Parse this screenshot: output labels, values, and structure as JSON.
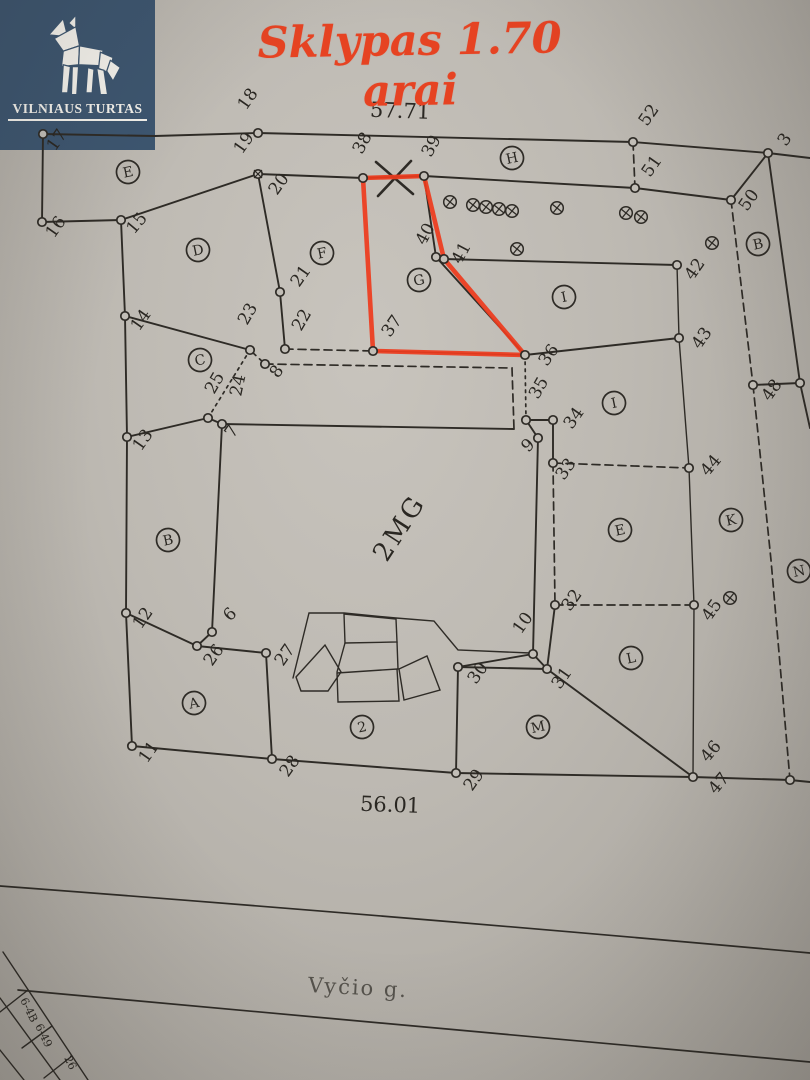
{
  "logo": {
    "brand": "VILNIAUS TURTAS",
    "icon": "wolf-icon",
    "bg_color": "#3d5670"
  },
  "title": {
    "text": "Sklypas 1.70 arai",
    "color": "#e64322"
  },
  "plan": {
    "top_dimension": "57.71",
    "bottom_dimension": "56.01",
    "building_label": "2MG",
    "street_label": "Vyčio g.",
    "highlight_color": "#ee3b1c",
    "corner_table_cells": [
      {
        "text": "6-4B",
        "x": 20,
        "y": 1000
      },
      {
        "text": "6-49",
        "x": 35,
        "y": 1026
      },
      {
        "text": "26",
        "x": 64,
        "y": 1058
      }
    ],
    "points": [
      {
        "label": "17",
        "x": 43,
        "y": 134,
        "lx": 55,
        "ly": 152,
        "r": -55
      },
      {
        "label": "18",
        "x": 258,
        "y": 133,
        "lx": 246,
        "ly": 111,
        "r": -55
      },
      {
        "label": "19",
        "x": 258,
        "y": 174,
        "lx": 242,
        "ly": 155,
        "r": -55,
        "crossed": true
      },
      {
        "label": "20",
        "x": 258,
        "y": 174,
        "lx": 277,
        "ly": 196,
        "r": -55,
        "nodot": true
      },
      {
        "label": "16",
        "x": 42,
        "y": 222,
        "lx": 54,
        "ly": 239,
        "r": -55
      },
      {
        "label": "15",
        "x": 121,
        "y": 220,
        "lx": 134,
        "ly": 235,
        "r": -50
      },
      {
        "label": "14",
        "x": 125,
        "y": 316,
        "lx": 139,
        "ly": 332,
        "r": -55
      },
      {
        "label": "13",
        "x": 127,
        "y": 437,
        "lx": 141,
        "ly": 452,
        "r": -55
      },
      {
        "label": "12",
        "x": 126,
        "y": 613,
        "lx": 141,
        "ly": 630,
        "r": -55
      },
      {
        "label": "11",
        "x": 132,
        "y": 746,
        "lx": 147,
        "ly": 764,
        "r": -55
      },
      {
        "label": "21",
        "x": 280,
        "y": 292,
        "lx": 299,
        "ly": 288,
        "r": -55
      },
      {
        "label": "22",
        "x": 285,
        "y": 349,
        "lx": 301,
        "ly": 332,
        "r": -60
      },
      {
        "label": "23",
        "x": 250,
        "y": 350,
        "lx": 247,
        "ly": 326,
        "r": -60
      },
      {
        "label": "24",
        "x": 250,
        "y": 350,
        "lx": 241,
        "ly": 397,
        "r": -78,
        "nodot": true
      },
      {
        "label": "25",
        "x": 208,
        "y": 418,
        "lx": 214,
        "ly": 395,
        "r": -60
      },
      {
        "label": "8",
        "x": 265,
        "y": 364,
        "lx": 278,
        "ly": 379,
        "r": -55
      },
      {
        "label": "7",
        "x": 222,
        "y": 424,
        "lx": 233,
        "ly": 439,
        "r": -55
      },
      {
        "label": "6",
        "x": 212,
        "y": 632,
        "lx": 230,
        "ly": 622,
        "r": -45
      },
      {
        "label": "26",
        "x": 197,
        "y": 646,
        "lx": 212,
        "ly": 667,
        "r": -55
      },
      {
        "label": "27",
        "x": 266,
        "y": 653,
        "lx": 283,
        "ly": 667,
        "r": -55
      },
      {
        "label": "28",
        "x": 272,
        "y": 759,
        "lx": 288,
        "ly": 778,
        "r": -55
      },
      {
        "label": "29",
        "x": 456,
        "y": 773,
        "lx": 472,
        "ly": 792,
        "r": -55
      },
      {
        "label": "30",
        "x": 458,
        "y": 667,
        "lx": 476,
        "ly": 685,
        "r": -55
      },
      {
        "label": "10",
        "x": 533,
        "y": 654,
        "lx": 521,
        "ly": 635,
        "r": -55
      },
      {
        "label": "31",
        "x": 547,
        "y": 669,
        "lx": 560,
        "ly": 690,
        "r": -55
      },
      {
        "label": "32",
        "x": 555,
        "y": 605,
        "lx": 570,
        "ly": 612,
        "r": -55
      },
      {
        "label": "9",
        "x": 538,
        "y": 438,
        "lx": 528,
        "ly": 453,
        "r": -45
      },
      {
        "label": "33",
        "x": 553,
        "y": 463,
        "lx": 564,
        "ly": 481,
        "r": -55
      },
      {
        "label": "34",
        "x": 553,
        "y": 420,
        "lx": 572,
        "ly": 430,
        "r": -55
      },
      {
        "label": "35",
        "x": 526,
        "y": 420,
        "lx": 538,
        "ly": 400,
        "r": -60
      },
      {
        "label": "36",
        "x": 525,
        "y": 355,
        "lx": 547,
        "ly": 367,
        "r": -55
      },
      {
        "label": "37",
        "x": 373,
        "y": 351,
        "lx": 390,
        "ly": 338,
        "r": -55
      },
      {
        "label": "38",
        "x": 363,
        "y": 178,
        "lx": 362,
        "ly": 155,
        "r": -62
      },
      {
        "label": "39",
        "x": 424,
        "y": 176,
        "lx": 431,
        "ly": 158,
        "r": -62
      },
      {
        "label": "40",
        "x": 436,
        "y": 257,
        "lx": 425,
        "ly": 246,
        "r": -62
      },
      {
        "label": "41",
        "x": 444,
        "y": 259,
        "lx": 461,
        "ly": 265,
        "r": -62
      },
      {
        "label": "42",
        "x": 677,
        "y": 265,
        "lx": 693,
        "ly": 281,
        "r": -55
      },
      {
        "label": "43",
        "x": 679,
        "y": 338,
        "lx": 700,
        "ly": 350,
        "r": -55
      },
      {
        "label": "44",
        "x": 689,
        "y": 468,
        "lx": 708,
        "ly": 477,
        "r": -50
      },
      {
        "label": "45",
        "x": 694,
        "y": 605,
        "lx": 710,
        "ly": 622,
        "r": -55
      },
      {
        "label": "46",
        "x": 693,
        "y": 777,
        "lx": 708,
        "ly": 763,
        "r": -50
      },
      {
        "label": "47",
        "x": 693,
        "y": 779,
        "lx": 716,
        "ly": 795,
        "r": -50,
        "nodot": true
      },
      {
        "label": "48",
        "x": 753,
        "y": 385,
        "lx": 770,
        "ly": 402,
        "r": -55
      },
      {
        "label": "50",
        "x": 731,
        "y": 200,
        "lx": 747,
        "ly": 212,
        "r": -55
      },
      {
        "label": "51",
        "x": 635,
        "y": 188,
        "lx": 650,
        "ly": 178,
        "r": -55
      },
      {
        "label": "52",
        "x": 633,
        "y": 142,
        "lx": 647,
        "ly": 127,
        "r": -55
      },
      {
        "label": "3",
        "x": 768,
        "y": 153,
        "lx": 786,
        "ly": 147,
        "r": -55
      },
      {
        "label": "",
        "x": 800,
        "y": 383
      },
      {
        "label": "",
        "x": 790,
        "y": 780
      }
    ],
    "letters": [
      {
        "label": "E",
        "x": 128,
        "y": 172
      },
      {
        "label": "D",
        "x": 198,
        "y": 250
      },
      {
        "label": "F",
        "x": 322,
        "y": 253
      },
      {
        "label": "G",
        "x": 419,
        "y": 280
      },
      {
        "label": "H",
        "x": 512,
        "y": 158
      },
      {
        "label": "I",
        "x": 564,
        "y": 297
      },
      {
        "label": "C",
        "x": 200,
        "y": 360
      },
      {
        "label": "I",
        "x": 614,
        "y": 403
      },
      {
        "label": "B",
        "x": 758,
        "y": 244
      },
      {
        "label": "B",
        "x": 168,
        "y": 540
      },
      {
        "label": "E",
        "x": 620,
        "y": 530
      },
      {
        "label": "K",
        "x": 731,
        "y": 520
      },
      {
        "label": "N",
        "x": 799,
        "y": 571
      },
      {
        "label": "L",
        "x": 631,
        "y": 658
      },
      {
        "label": "M",
        "x": 538,
        "y": 727
      },
      {
        "label": "A",
        "x": 194,
        "y": 703
      },
      {
        "label": "2",
        "x": 362,
        "y": 727
      }
    ],
    "survey_marks": [
      [
        450,
        202
      ],
      [
        473,
        205
      ],
      [
        486,
        207
      ],
      [
        499,
        209
      ],
      [
        512,
        211
      ],
      [
        557,
        208
      ],
      [
        626,
        213
      ],
      [
        641,
        217
      ],
      [
        517,
        249
      ],
      [
        712,
        243
      ],
      [
        730,
        598
      ]
    ],
    "highlight_polygon": [
      [
        363,
        178
      ],
      [
        424,
        176
      ],
      [
        444,
        259
      ],
      [
        525,
        355
      ],
      [
        373,
        351
      ]
    ]
  }
}
